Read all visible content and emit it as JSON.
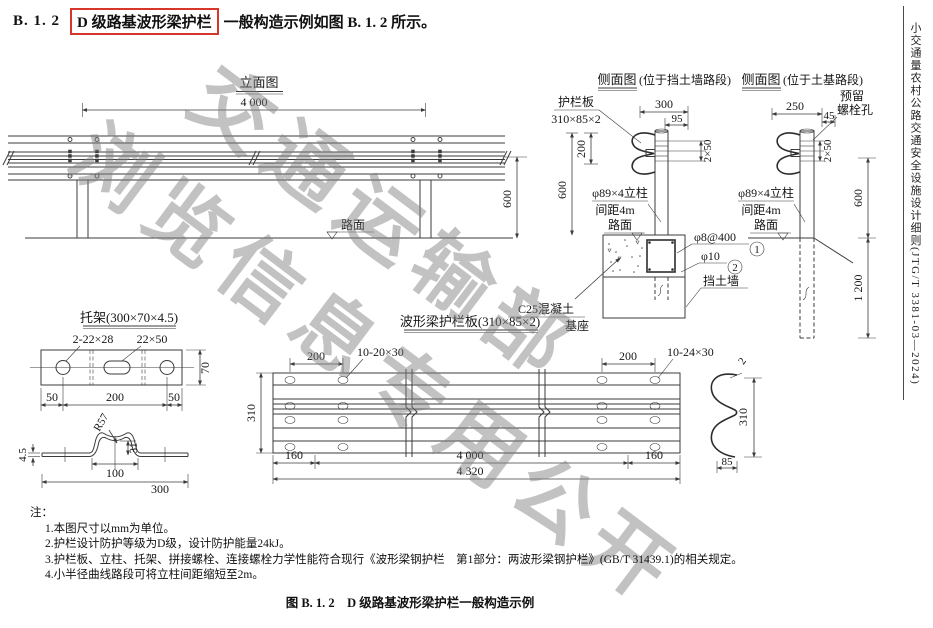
{
  "colors": {
    "highlight_box": "#d6372a",
    "line": "#3b3b3b",
    "watermark": "#808080"
  },
  "header": {
    "number": "B. 1. 2",
    "highlight": "D 级路基波形梁护栏",
    "rest": "一般构造示例如图 B. 1. 2 所示。"
  },
  "sidebar": {
    "text": "小交通量农村公路交通安全设施设计细则(JTG/T 3381-03—2024)"
  },
  "watermark": {
    "line1": "交通运输部",
    "line2": "浏览信息专用公开"
  },
  "elevation": {
    "title": "立面图",
    "dim_4000": "4 000",
    "dim_600": "600",
    "road_label": "路面"
  },
  "side_wall": {
    "title": "侧面图",
    "title_suffix": "(位于挡土墙路段)",
    "plate_label_line1": "护栏板",
    "plate_label_line2": "310×85×2",
    "dim_300": "300",
    "dim_95": "95",
    "dim_200_top": "200",
    "dim_2x50": "2×50",
    "post_label_line1": "φ89×4立柱",
    "post_label_line2": "间距4m",
    "road_label": "路面",
    "dim_600_top": "600",
    "dim_200_bottom": "200",
    "dim_600_bottom": "600",
    "rebar1_label": "φ8@400",
    "rebar1_num": "1",
    "rebar2_label": "φ10",
    "rebar2_num": "2",
    "wall_label": "挡土墙",
    "base_label_line1": "C25混凝土",
    "base_label_line2": "基座"
  },
  "side_soil": {
    "title": "侧面图",
    "title_suffix": "(位于土基路段)",
    "bolt_label_line1": "预留",
    "bolt_label_line2": "螺栓孔",
    "dim_250": "250",
    "dim_45": "45",
    "dim_2x50": "2×50",
    "post_label_line1": "φ89×4立柱",
    "post_label_line2": "间距4m",
    "road_label": "路面",
    "dim_600": "600",
    "dim_1200": "1 200"
  },
  "bracket": {
    "title": "托架(300×70×4.5)",
    "holes_label": "2-22×28",
    "slot_label": "22×50",
    "dim_70": "70",
    "dim_50_left": "50",
    "dim_200": "200",
    "dim_50_right": "50",
    "radius_label": "R57",
    "dim_4_5": "4.5",
    "dim_31": "31",
    "dim_100": "100",
    "dim_300": "300"
  },
  "plate": {
    "title": "波形梁护栏板(310×85×2)",
    "dim_310": "310",
    "dim_200_left": "200",
    "holes_left_label": "10-20×30",
    "dim_200_right": "200",
    "holes_right_label": "10-24×30",
    "dim_160_left": "160",
    "dim_4000": "4 000",
    "dim_160_right": "160",
    "dim_4320": "4 320"
  },
  "beam_section": {
    "dim_2": "2",
    "dim_310": "310",
    "dim_85": "85"
  },
  "notes": {
    "label": "注：",
    "items": [
      "1.本图尺寸以mm为单位。",
      "2.护栏设计防护等级为D级，设计防护能量24kJ。",
      "3.护栏板、立柱、托架、拼接螺栓、连接螺栓力学性能符合现行《波形梁钢护栏　第1部分：两波形梁钢护栏》(GB/T 31439.1)的相关规定。",
      "4.小半径曲线路段可将立柱间距缩短至2m。"
    ]
  },
  "caption": {
    "text": "图 B. 1. 2　D 级路基波形梁护栏一般构造示例"
  }
}
